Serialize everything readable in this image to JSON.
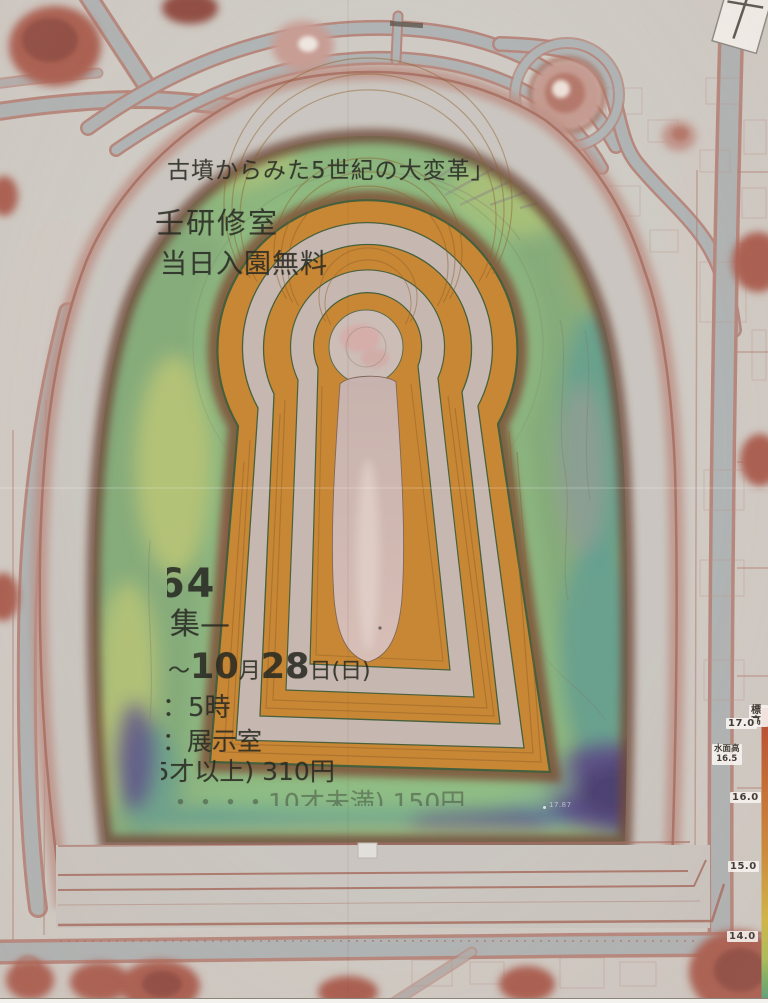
{
  "map": {
    "flyer": {
      "title": "古墳からみた5世紀の大変革」",
      "room_line": "壬研修室",
      "free_line": "当日入園無料",
      "big_number": "64",
      "recruit_line": "集—",
      "date": {
        "tilde": "～",
        "d1": "10",
        "month": "月",
        "d2": "28",
        "day": "日(日)"
      },
      "time_line": "：5時",
      "room2_line": "：展示室",
      "price_line1": "5才以上) 310円",
      "price_line2": "・・・・10才未満) 150円"
    },
    "elevation_labels": [
      {
        "text": "標高"
      },
      {
        "text": "17.0"
      },
      {
        "text": "水面高"
      },
      {
        "text": "16.5"
      },
      {
        "text": "16.0"
      },
      {
        "text": "15.0"
      },
      {
        "text": "14.0"
      }
    ],
    "spot_elevation": "17.87",
    "colors": {
      "bg": "#cfccc6",
      "road": "#aeb3b4",
      "road-edge": "#b5847a",
      "bank": "#cac6c1",
      "bank-edge": "#a5685c",
      "bank-slope": "#bb8d82",
      "moat": "#83ab79",
      "moat-bright": "#90c285",
      "moat-yellow": "#b9c673",
      "moat-olive": "#9aa868",
      "moat-teal": "#5f9d90",
      "moat-purple": "#574a87",
      "moat-deep-purple": "#453a6e",
      "moat-slate": "#5f7fa5",
      "slope-dark": "#6b4536",
      "mound-rim": "#7a4c30",
      "terrace-orange": "#c8842f",
      "terrace-contour": "#8a5a22",
      "terrace-gray": "#c6bab6",
      "outline-green": "#3f5a36",
      "summit": "#cdbfbb",
      "ridge": "#d2bab5",
      "ridge-light": "#e5d4cd",
      "shoulder": "#c4a09c",
      "tree": "#a85a4c",
      "tree-dark": "#8d463c"
    }
  }
}
